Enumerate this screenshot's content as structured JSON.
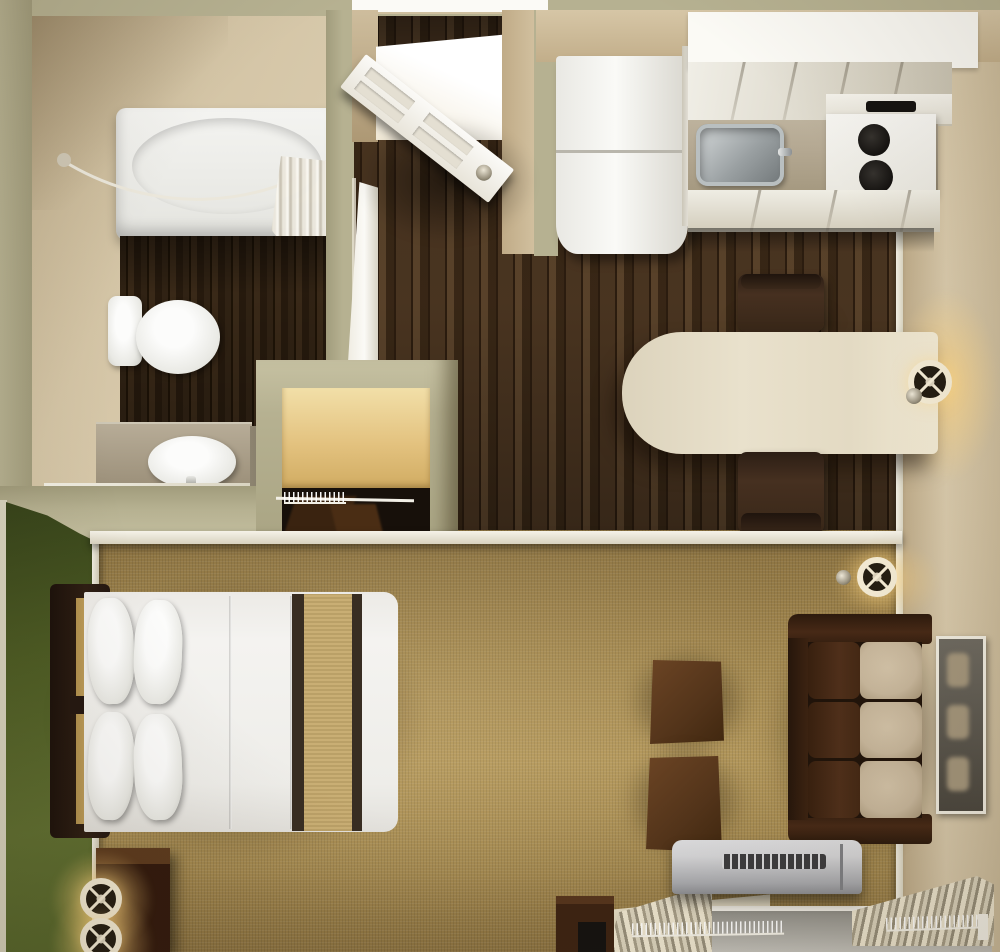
{
  "scene": {
    "kind": "3d-rendered-studio-apartment-floor-plan",
    "view": "top-down",
    "rooms": [
      {
        "name": "bathroom",
        "furniture": [
          "bathtub",
          "shower-curtain",
          "shower-rod",
          "toilet",
          "vanity-sink"
        ]
      },
      {
        "name": "entry",
        "furniture": [
          "entry-door",
          "bathroom-door"
        ]
      },
      {
        "name": "kitchen",
        "furniture": [
          "refrigerator",
          "upper-cabinets",
          "countertop",
          "kitchen-sink",
          "stove-cooktop",
          "lower-cabinets"
        ]
      },
      {
        "name": "dining-area",
        "furniture": [
          "dining-table",
          "dining-chair-top",
          "dining-chair-bottom",
          "wall-sconce"
        ]
      },
      {
        "name": "closet",
        "furniture": [
          "desk-shelf",
          "clothes-rod",
          "hangers",
          "hanging-clothes"
        ]
      },
      {
        "name": "bedroom",
        "furniture": [
          "bed",
          "headboard",
          "pillows",
          "nightstand",
          "table-lamp",
          "table-lamp"
        ]
      },
      {
        "name": "living-area",
        "furniture": [
          "sofa",
          "ottoman",
          "ottoman",
          "wall-mirror",
          "wall-sconce",
          "ac-unit",
          "window-drapes",
          "media-cabinet"
        ]
      }
    ]
  },
  "colors": {
    "wall_khaki": "#b6b191",
    "wall_khaki_dark": "#a19c7c",
    "wall_edge": "#d8d4bf",
    "wall_beige": "#d8c9ab",
    "wall_beige_dark": "#bca987",
    "wall_beige_deep": "#ab9672",
    "white": "#f7f5ef",
    "off_white": "#eceadf",
    "wood_a": "#4a3521",
    "wood_b": "#382716",
    "wood_c": "#5a432b",
    "wood_d": "#2b1c0f",
    "carpet": "#a2874e",
    "carpet_light": "#b29659",
    "carpet_dark": "#8a7140",
    "green_dark": "#36431a",
    "green": "#4d5c24",
    "green_light": "#5f6f31",
    "cream": "#e8e0cb",
    "counter": "#b4a892",
    "vanity": "#a2967f",
    "stainless_light": "#d7dbdc",
    "stainless": "#9aa0a2",
    "stainless_dark": "#6f7577",
    "sofa_dark": "#371f10",
    "sofa_mid": "#4c2d18",
    "cushion": "#c8b79c",
    "brown": "#573521",
    "brown_dark": "#351f0e",
    "espresso": "#2f2015",
    "bed_white": "#f2f1ed",
    "stripe_dark": "#382d22",
    "stripe_tan": "#c6aa6d",
    "glow": "#ffd78e",
    "sconce_ring": "#f2e9d2",
    "sconce_dark": "#241d12",
    "ac_light": "#d4d4d6",
    "ac_mid": "#a7a8ac",
    "ac_dark": "#3c3c3e",
    "glass": "#8f8d86",
    "drape": "#cfc7b1",
    "drape_dark": "#8e8672",
    "black": "#141210",
    "door_white": "#f6f4ee"
  }
}
